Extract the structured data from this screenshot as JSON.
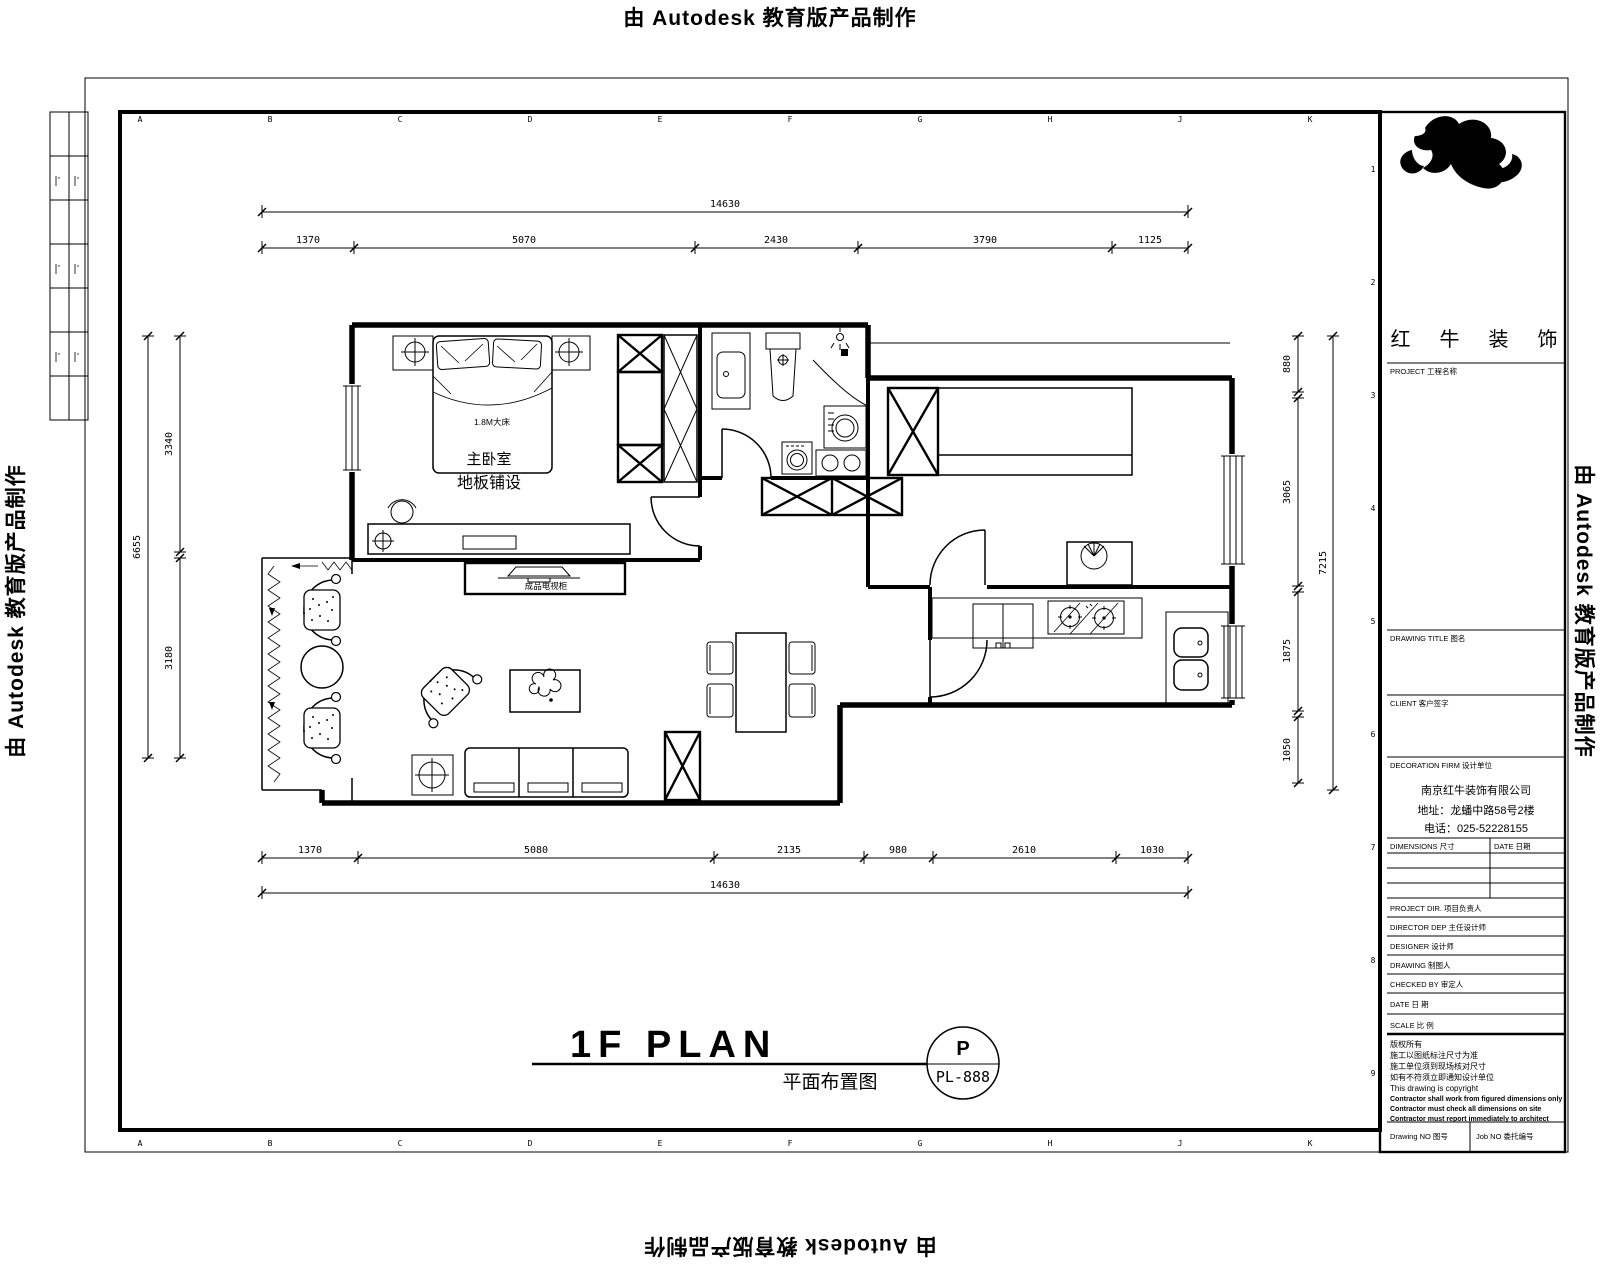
{
  "watermark": {
    "text": "由 Autodesk 教育版产品制作"
  },
  "sheet": {
    "grid_letters": [
      "A",
      "B",
      "C",
      "D",
      "E",
      "F",
      "G",
      "H",
      "J",
      "K"
    ],
    "grid_numbers": [
      "1",
      "2",
      "3",
      "4",
      "5",
      "6",
      "7",
      "8",
      "9"
    ]
  },
  "title_block": {
    "logo_text": "红 牛 装 饰",
    "project_label": "PROJECT  工程名称",
    "drawing_title_label": "DRAWING TITLE  图名",
    "client_label": "CLIENT  客户签字",
    "firm_label": "DECORATION FIRM  设计单位",
    "firm_name": "南京红牛装饰有限公司",
    "firm_address": "地址：龙蟠中路58号2楼",
    "firm_phone": "电话：025-52228155",
    "dimensions_label": "DIMENSIONS 尺寸",
    "date_label": "DATE 日期",
    "project_dir_label": "PROJECT DIR.  项目负责人",
    "director_label": "DIRECTOR DEP  主任设计师",
    "designer_label": "DESIGNER  设计师",
    "drawing_label": "DRAWING  制图人",
    "checked_label": "CHECKED BY  审定人",
    "date_row_label": "DATE  日 期",
    "scale_label": "SCALE  比 例",
    "notes": [
      "版权所有",
      "施工以图纸标注尺寸为准",
      "施工单位须到现场核对尺寸",
      "如有不符须立即通知设计单位",
      "This drawing is copyright",
      "Contractor shall work from figured dimensions only",
      "Contractor must check all dimensions on site",
      "Contractor must report immediately to architect"
    ],
    "drawing_no_label": "Drawing NO 图号",
    "job_no_label": "Job NO 委托编号"
  },
  "plan": {
    "title_en": "1F PLAN",
    "title_cn": "平面布置图",
    "badge_letter": "P",
    "badge_code": "PL-888",
    "labels": {
      "master_bedroom": "主卧室",
      "floor_note": "地板铺设",
      "bed_size": "1.8M大床",
      "tv_cabinet": "成品电视柜"
    },
    "dims": {
      "top_total": "14630",
      "top_segments": [
        "1370",
        "5070",
        "2430",
        "3790",
        "1125"
      ],
      "bottom_segments": [
        "1370",
        "5080",
        "2135",
        "980",
        "2610",
        "1030"
      ],
      "bottom_total": "14630",
      "left_total": "6655",
      "left_segments": [
        "3340",
        "3180"
      ],
      "right_total": "7215",
      "right_segments": [
        "880",
        "3065",
        "1875",
        "1050"
      ]
    }
  }
}
